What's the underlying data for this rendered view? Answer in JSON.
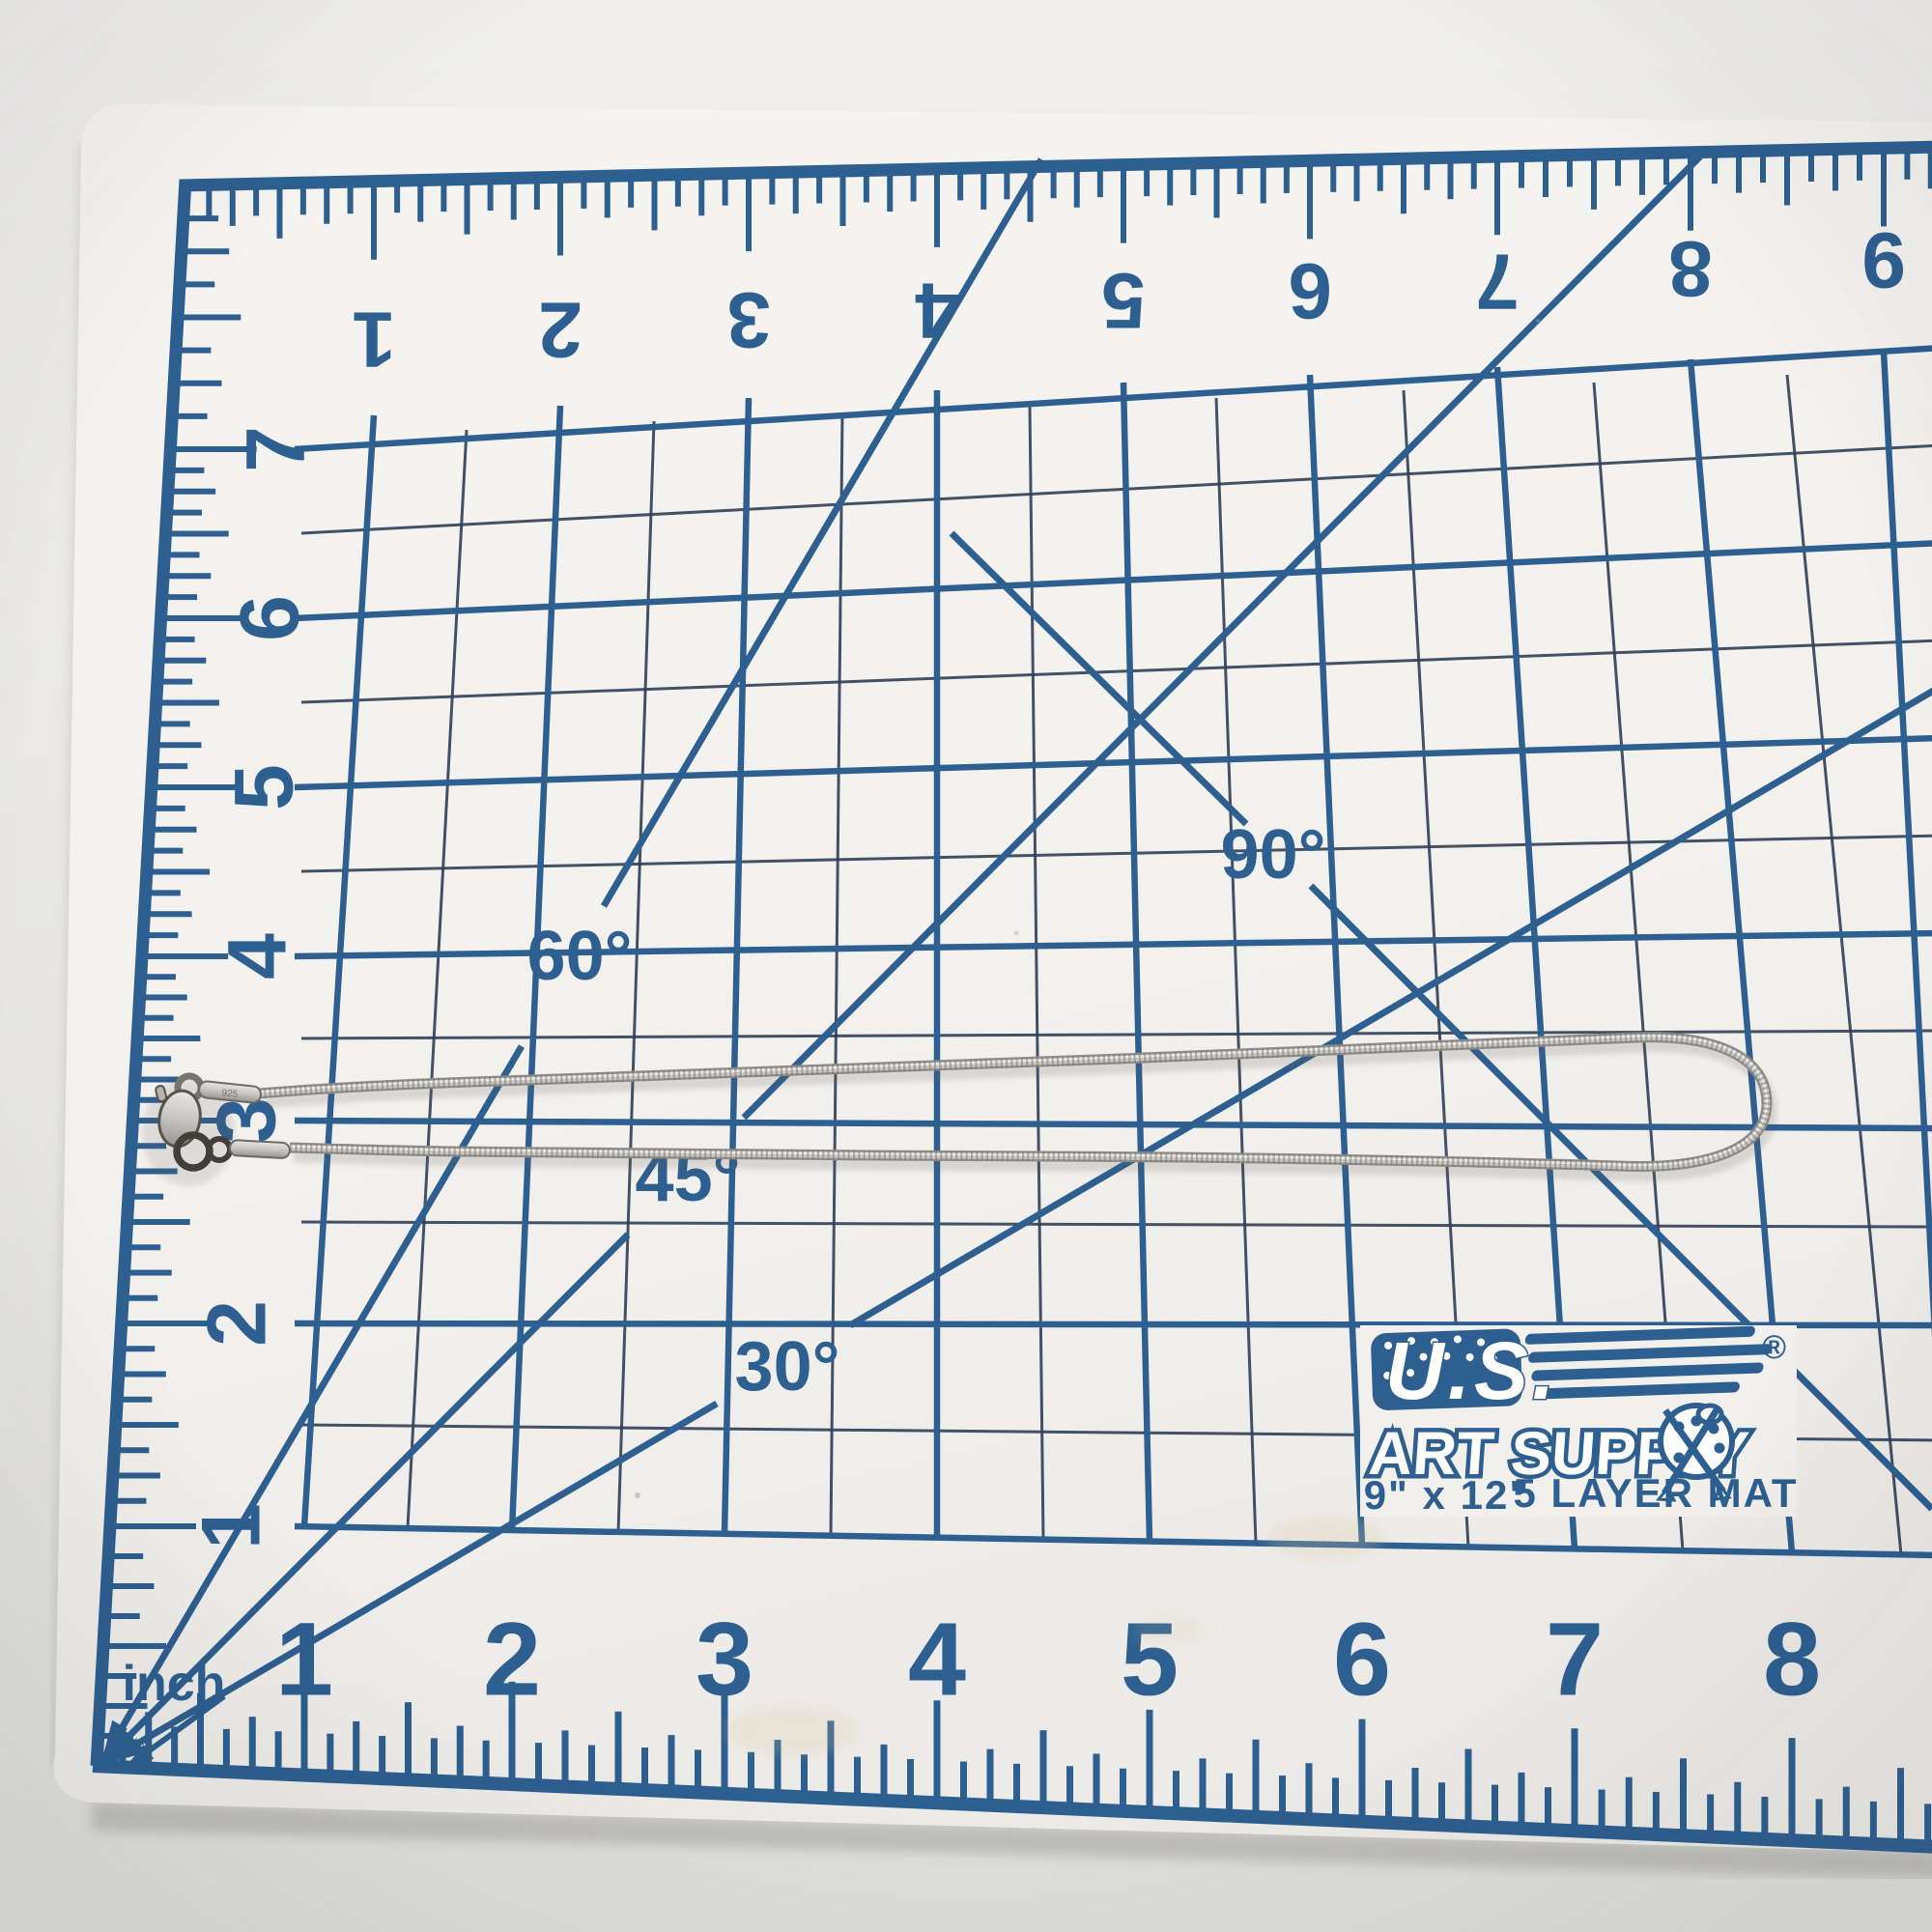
{
  "scene": {
    "description": "Silver snake-chain necklace with lobster clasp laid flat on a blue-ruled self-healing cutting mat, photographed from above",
    "background_color": "#e9e8e6"
  },
  "mat": {
    "surface_color": "#f3f1ee",
    "ruling_color": "#2d5f90",
    "fine_line_color": "#2f4058",
    "unit_label": "inch",
    "top_numbers": [
      "1",
      "2",
      "3",
      "4",
      "5",
      "6",
      "7",
      "8",
      "9"
    ],
    "left_numbers": [
      "7",
      "6",
      "5",
      "4",
      "3",
      "2",
      "1"
    ],
    "bottom_numbers": [
      "1",
      "2",
      "3",
      "4",
      "5",
      "6",
      "7",
      "8"
    ],
    "angle_labels": {
      "deg30": "30°",
      "deg45": "45°",
      "deg60": "60°",
      "deg90": "90°"
    },
    "logo": {
      "brand_top": "U.S.",
      "brand_bottom": "ART SUPPLY",
      "registered": "®",
      "size_text": "9\" x 12\"",
      "type_text": "5 LAYER MAT"
    }
  },
  "necklace": {
    "chain_color": "#c9c8c4",
    "clasp_type": "lobster-clasp",
    "stamp": "925"
  }
}
